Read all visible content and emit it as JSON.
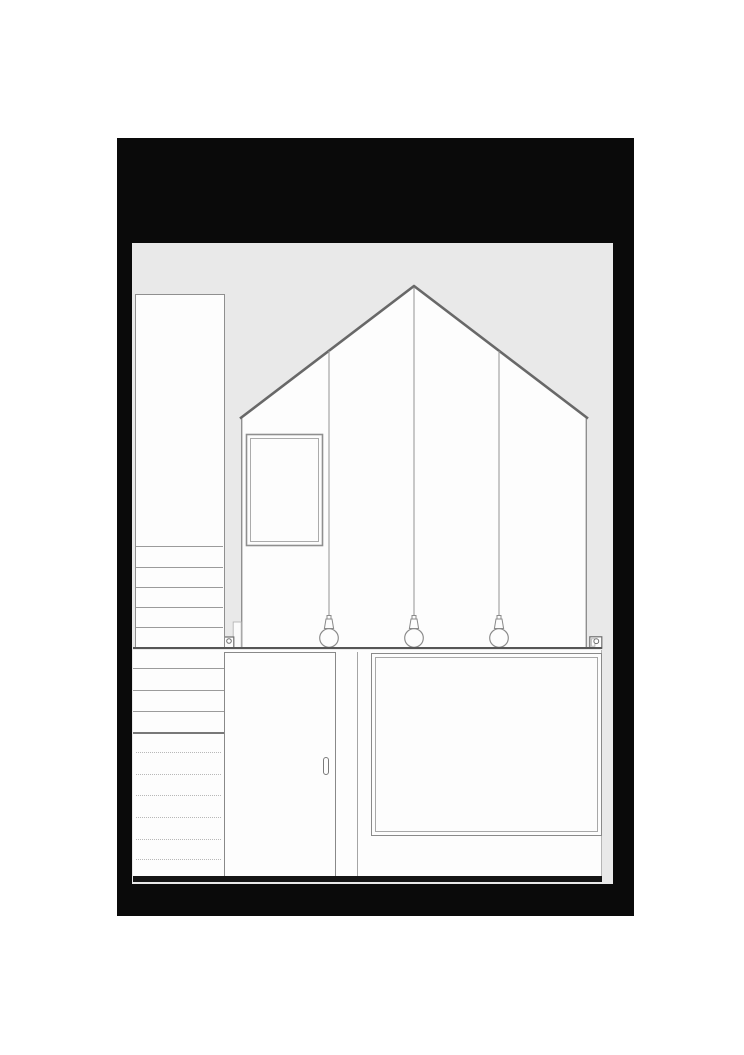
{
  "meta": {
    "description": "Black-matted architectural sectional elevation drawing: gabled upper wall with three hanging pendant bulbs, picture window on gable, staircase shaft at left, storefront with sliding door and large display window below"
  },
  "colors": {
    "page_background": "#ffffff",
    "mat_frame": "#0a0a0a",
    "canvas_background": "#e9e9e9",
    "wall_white": "#fdfdfd",
    "roof_line": "#686868",
    "edge_line": "#8f8f8f",
    "thin_line": "#9b9b9b",
    "dashed_line": "#b8b8b8",
    "floor_line": "#565656",
    "ground_line": "#151515"
  },
  "inventory": {
    "pendant_lights_count": 3,
    "upper_stair_treads_count": 5,
    "lower_stair_treads_count": 4,
    "hidden_dashed_treads_count": 6,
    "gable_window_count": 1,
    "storefront_window_count": 1,
    "door_count": 1,
    "track_brackets_count": 2
  }
}
